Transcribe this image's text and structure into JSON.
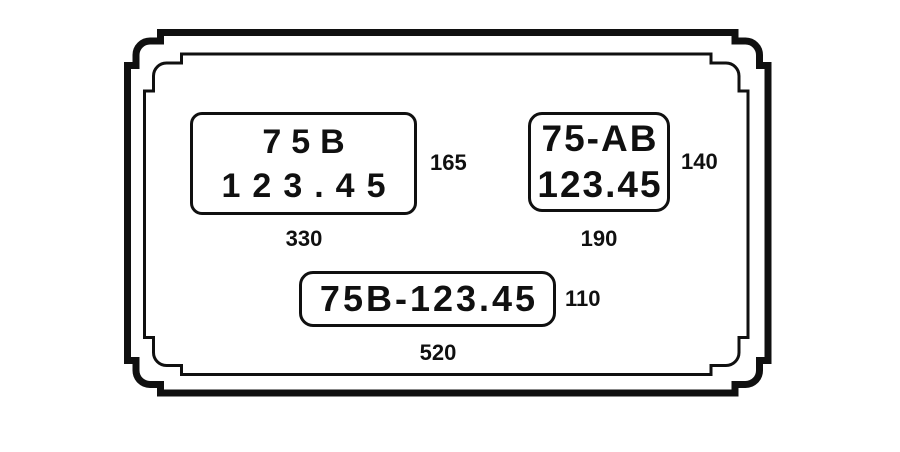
{
  "diagram": {
    "background_color": "#ffffff",
    "ink_color": "#101010",
    "plates": [
      {
        "lines": [
          "75B",
          "123.45"
        ],
        "width_label": "330",
        "height_label": "165"
      },
      {
        "lines": [
          "75-AB",
          "123.45"
        ],
        "width_label": "190",
        "height_label": "140"
      },
      {
        "lines": [
          "75B-123.45"
        ],
        "width_label": "520",
        "height_label": "110"
      }
    ]
  }
}
